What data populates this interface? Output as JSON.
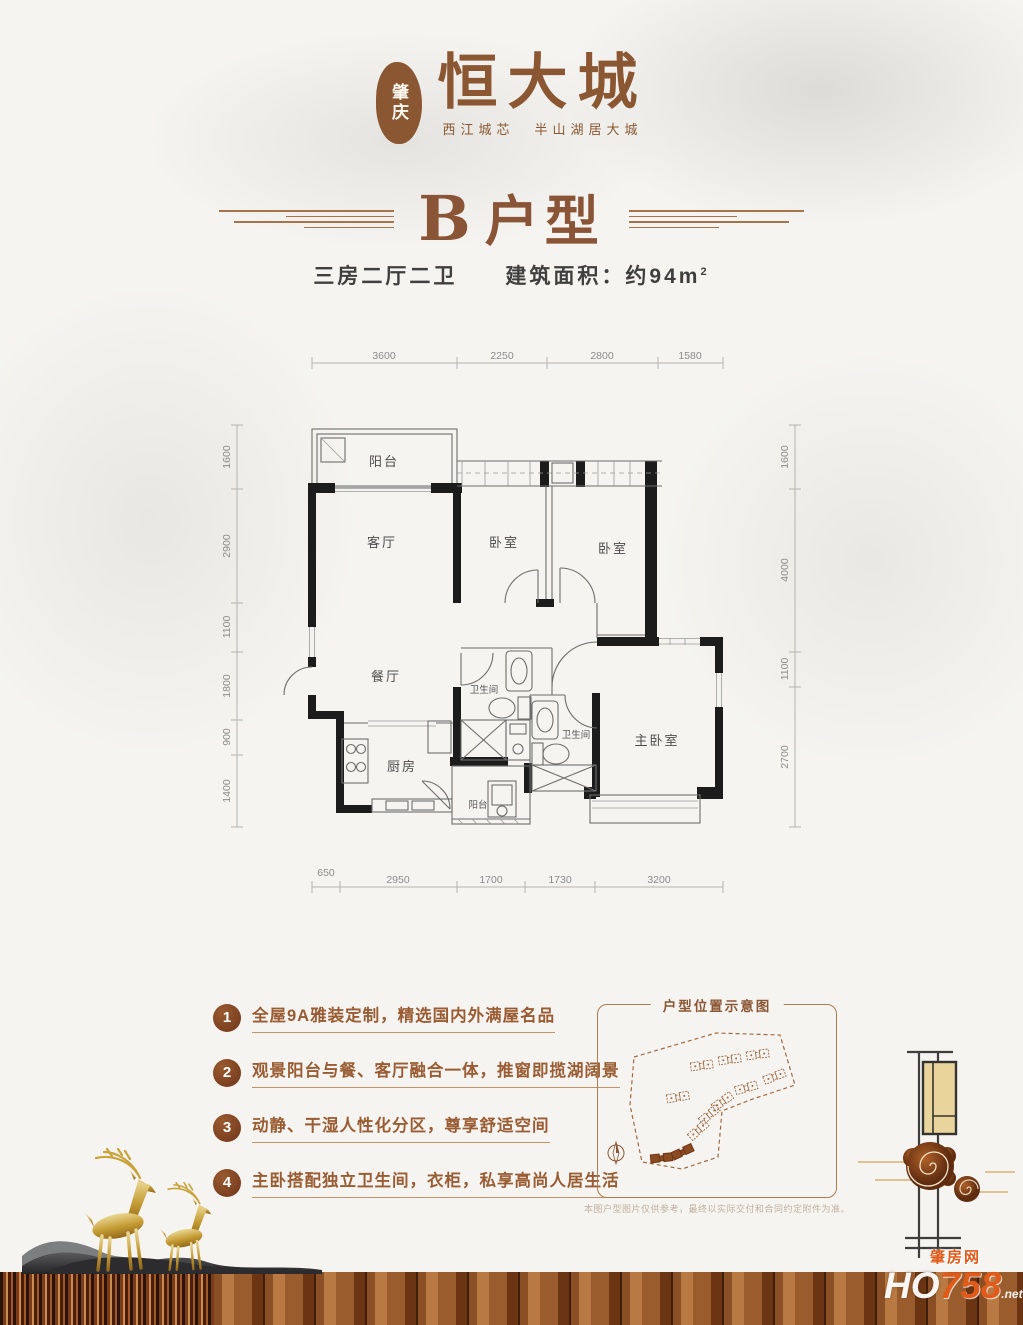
{
  "logo": {
    "seal": "肇庆",
    "brand": "恒大城",
    "tagline_left": "西江城芯",
    "tagline_right": "半山湖居大城"
  },
  "header": {
    "title_letter": "B",
    "title_word": "户型",
    "spec": "三房二厅二卫",
    "area_label": "建筑面积：约94m",
    "area_sup": "2"
  },
  "plan": {
    "rooms": {
      "balcony_top": "阳台",
      "living": "客厅",
      "bedroom1": "卧室",
      "bedroom2": "卧室",
      "dining": "餐厅",
      "kitchen": "厨房",
      "bath1": "卫生间",
      "bath2": "卫生间",
      "balcony_bottom": "阳台",
      "master": "主卧室"
    },
    "dims_top": [
      "3600",
      "2250",
      "2800",
      "1580"
    ],
    "dims_left": [
      "1600",
      "2900",
      "1100",
      "1800",
      "900",
      "1400"
    ],
    "dims_right": [
      "1600",
      "4000",
      "1100",
      "2700"
    ],
    "dims_bottom": [
      "650",
      "2950",
      "1700",
      "1730",
      "3200"
    ]
  },
  "features": [
    {
      "num": "1",
      "text": "全屋9A雅装定制，精选国内外满屋名品"
    },
    {
      "num": "2",
      "text": "观景阳台与餐、客厅融合一体，推窗即揽湖阔景"
    },
    {
      "num": "3",
      "text": "动静、干湿人性化分区，尊享舒适空间"
    },
    {
      "num": "4",
      "text": "主卧搭配独立卫生间，衣柜，私享高尚人居生活"
    }
  ],
  "map": {
    "title": "户型位置示意图",
    "disclaimer": "本图户型图片仅供参考，最终以实际交付和合同约定附件为准。"
  },
  "watermark": {
    "cn": "肇房网",
    "en_bold": "HO",
    "en_num": "758",
    "suffix": ".net"
  },
  "colors": {
    "brand_brown": "#8a5732",
    "title_brown": "#8a5436",
    "badge_brown": "#7a4022",
    "feature_text": "#9a5c33",
    "wall_black": "#1c1c1c",
    "dim_gray": "#8c8c8c",
    "map_border": "#ab7b50",
    "wood_dark": "#5f3416",
    "wood_light": "#b87a42",
    "gold": "#c49b33",
    "watermark_orange": "#e05a1a"
  }
}
